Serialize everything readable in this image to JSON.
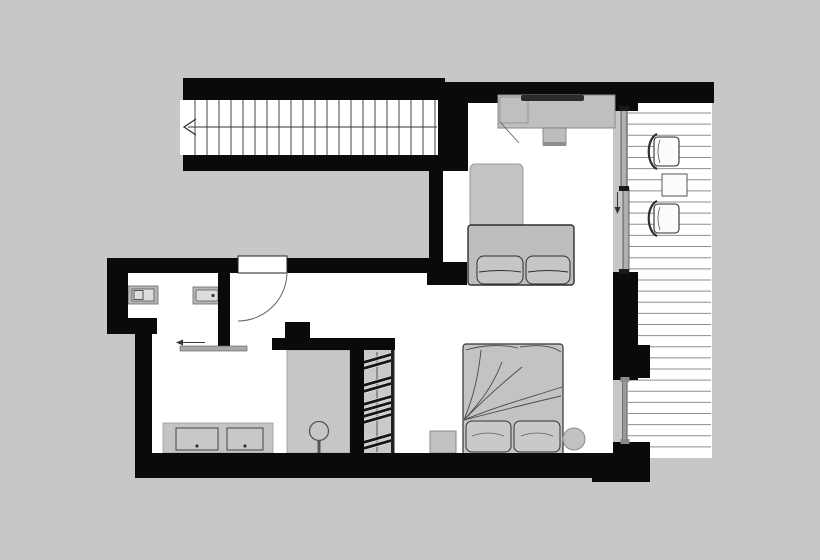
{
  "document": {
    "type": "floor-plan",
    "drawing": "apartment upper level"
  },
  "palette": {
    "background": "#c7c7c7",
    "floor": "#ffffff",
    "wall": "#0a0a0a",
    "furniture_fill": "#c1c1c1",
    "outline_dark": "#2e2e2e",
    "outline_light": "#8a8a8a",
    "deck_line": "#8e8e8e",
    "glass_door": "#a8a8a8"
  },
  "rooms": {
    "staircase": "staircase",
    "hall": "entry hall",
    "bathroom": "bathroom",
    "shower": "shower",
    "wardrobe": "wardrobe",
    "living": "living area",
    "sleeping": "sleeping area",
    "balcony": "balcony"
  },
  "furniture": {
    "desk": "desk with laptop",
    "desk_chair": "desk chair",
    "chaise": "lounge chaise",
    "sofa": "two-seat sofa",
    "bed": "double bed with two pillows",
    "nightstand": "nightstand",
    "stool": "round stool",
    "vanity": "double-sink vanity",
    "toilet": "wall-hung toilet",
    "bidet": "bidet",
    "shower_drain": "shower drain column",
    "balcony_chair": "balcony armchair",
    "balcony_table": "balcony side table"
  },
  "symbols": {
    "stair_arrow": "stair direction arrow pointing left",
    "entry_door": "quarter-circle swing door",
    "bath_door": "sliding door, slides left",
    "glass_door": "sliding glass door to balcony",
    "glass_door_arrow": "slide direction arrow pointing down",
    "window": "window"
  },
  "decor": {
    "stair_treads": {
      "count": 21,
      "x_start": 195,
      "x_step": 12,
      "y1": 100,
      "y2": 155
    },
    "deck_lines": {
      "count": 31,
      "y_start": 113,
      "y_step": 11.13,
      "x1": 628,
      "x2": 711
    },
    "hangers": {
      "x": 361,
      "width": 31,
      "height": 3.4,
      "angle": -16,
      "ys": [
        357,
        363,
        380,
        386,
        399,
        405,
        411,
        417,
        437,
        443
      ]
    }
  }
}
